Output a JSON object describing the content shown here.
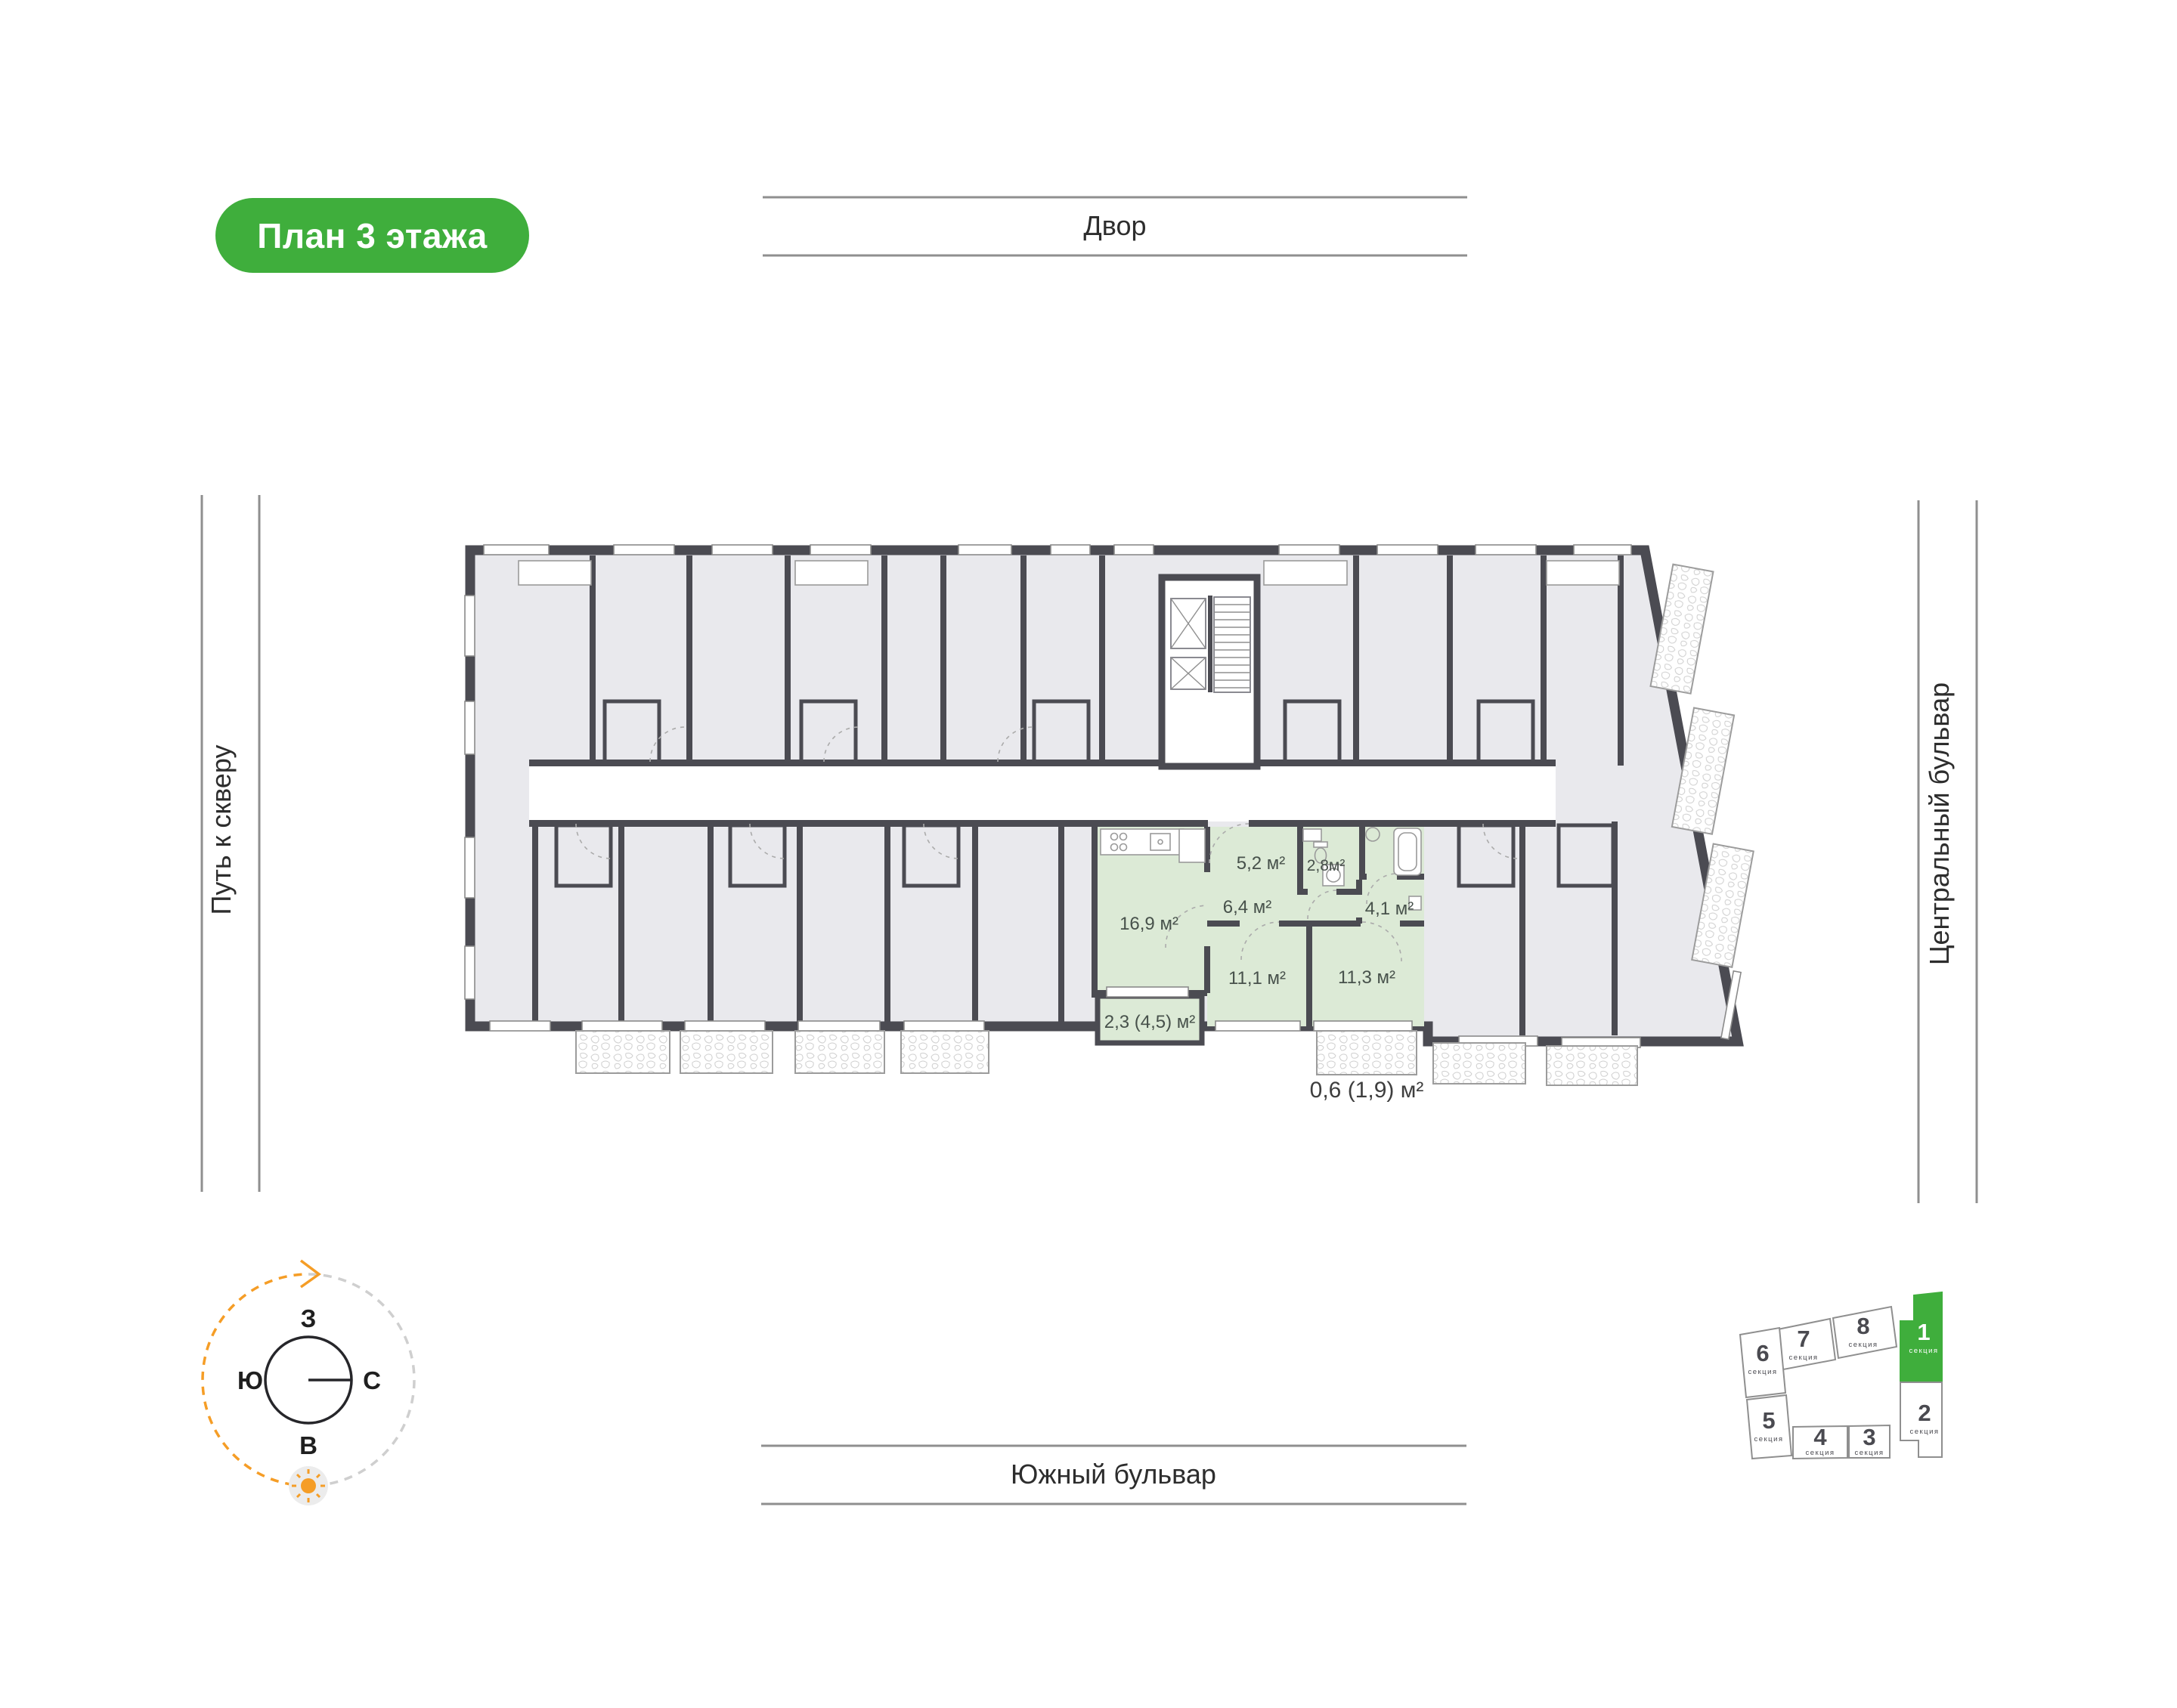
{
  "badge": {
    "label": "План 3 этажа"
  },
  "streets": {
    "top": "Двор",
    "left": "Путь к скверу",
    "right": "Центральный бульвар",
    "bottom": "Южный бульвар"
  },
  "compass": {
    "west": "З",
    "south": "Ю",
    "north": "С",
    "east": "В"
  },
  "apartment": {
    "rooms": [
      {
        "name": "kitchen-living",
        "area": "16,9 м²"
      },
      {
        "name": "hallway",
        "area": "5,2 м²"
      },
      {
        "name": "bathroom",
        "area": "2,8м²"
      },
      {
        "name": "inner-hall",
        "area": "6,4 м²"
      },
      {
        "name": "corridor",
        "area": "4,1 м²"
      },
      {
        "name": "bedroom-1",
        "area": "11,1 м²"
      },
      {
        "name": "bedroom-2",
        "area": "11,3 м²"
      },
      {
        "name": "loggia",
        "area": "2,3 (4,5) м²"
      }
    ],
    "balcony_area": "0,6 (1,9) м²"
  },
  "sections": {
    "caption": "секция",
    "items": [
      {
        "num": "1",
        "active": true
      },
      {
        "num": "2",
        "active": false
      },
      {
        "num": "3",
        "active": false
      },
      {
        "num": "4",
        "active": false
      },
      {
        "num": "5",
        "active": false
      },
      {
        "num": "6",
        "active": false
      },
      {
        "num": "7",
        "active": false
      },
      {
        "num": "8",
        "active": false
      }
    ]
  },
  "colors": {
    "green": "#3fae3c",
    "aptgreen": "#dcead6",
    "wall": "#4b4b52",
    "room": "#e9e9ed",
    "orange": "#f59d26",
    "linegray": "#8f8f8f"
  }
}
